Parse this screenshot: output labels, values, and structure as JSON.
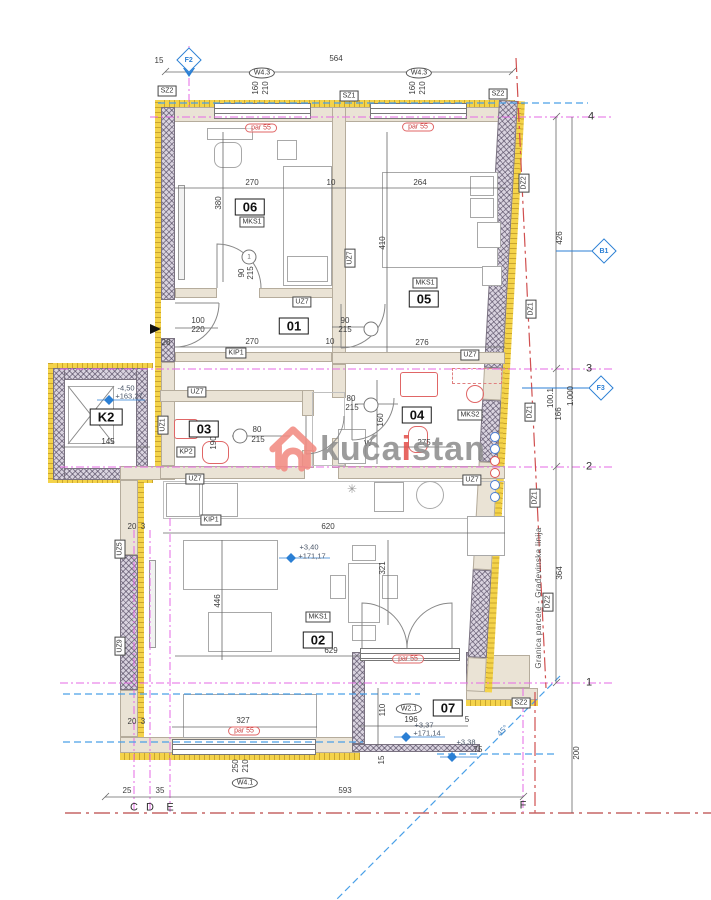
{
  "watermark": {
    "part1": "kuća",
    "part2": "i",
    "part3": "stan"
  },
  "colors": {
    "insulation_yellow": "#f4d34a",
    "wall_beige": "#eae3d5",
    "grid_magenta": "#e66ae6",
    "envelope_blue": "#4aa0e8",
    "boundary_red": "#d05050",
    "fixture_red": "#e06666",
    "marker_blue": "#2b7fd4",
    "watermark_gray": "#8f8f8f",
    "watermark_accent": "#e4534d"
  },
  "annotations": {
    "dimensions": [
      {
        "t": "15",
        "x": 159,
        "y": 61
      },
      {
        "t": "564",
        "x": 336,
        "y": 59
      },
      {
        "t": "270",
        "x": 252,
        "y": 183
      },
      {
        "t": "10",
        "x": 331,
        "y": 183
      },
      {
        "t": "264",
        "x": 420,
        "y": 183
      },
      {
        "t": "270",
        "x": 252,
        "y": 342
      },
      {
        "t": "10",
        "x": 330,
        "y": 342
      },
      {
        "t": "276",
        "x": 422,
        "y": 343
      },
      {
        "t": "100",
        "x": 198,
        "y": 321
      },
      {
        "t": "220",
        "x": 198,
        "y": 330
      },
      {
        "t": "28",
        "x": 166,
        "y": 343
      },
      {
        "t": "90",
        "x": 345,
        "y": 321
      },
      {
        "t": "215",
        "x": 345,
        "y": 330
      },
      {
        "t": "80",
        "x": 257,
        "y": 430
      },
      {
        "t": "215",
        "x": 258,
        "y": 440
      },
      {
        "t": "80",
        "x": 351,
        "y": 399
      },
      {
        "t": "215",
        "x": 352,
        "y": 408
      },
      {
        "t": "275",
        "x": 424,
        "y": 443
      },
      {
        "t": "145",
        "x": 108,
        "y": 442
      },
      {
        "t": "620",
        "x": 328,
        "y": 527
      },
      {
        "t": "629",
        "x": 331,
        "y": 651
      },
      {
        "t": "20",
        "x": 132,
        "y": 527
      },
      {
        "t": "3",
        "x": 143,
        "y": 527
      },
      {
        "t": "20",
        "x": 132,
        "y": 722
      },
      {
        "t": "3",
        "x": 143,
        "y": 722
      },
      {
        "t": "327",
        "x": 243,
        "y": 721
      },
      {
        "t": "196",
        "x": 411,
        "y": 720
      },
      {
        "t": "5",
        "x": 467,
        "y": 720
      },
      {
        "t": "75",
        "x": 478,
        "y": 750
      },
      {
        "t": "25",
        "x": 127,
        "y": 791
      },
      {
        "t": "35",
        "x": 160,
        "y": 791
      },
      {
        "t": "593",
        "x": 345,
        "y": 791
      },
      {
        "t": "W",
        "x": 368,
        "y": 444
      }
    ],
    "vertical_dimensions": [
      {
        "t": "160",
        "x": 256,
        "y": 88
      },
      {
        "t": "210",
        "x": 266,
        "y": 88
      },
      {
        "t": "160",
        "x": 413,
        "y": 88
      },
      {
        "t": "210",
        "x": 423,
        "y": 88
      },
      {
        "t": "380",
        "x": 219,
        "y": 203
      },
      {
        "t": "410",
        "x": 383,
        "y": 243
      },
      {
        "t": "90",
        "x": 242,
        "y": 273
      },
      {
        "t": "215",
        "x": 251,
        "y": 273
      },
      {
        "t": "160",
        "x": 381,
        "y": 420
      },
      {
        "t": "190",
        "x": 214,
        "y": 443
      },
      {
        "t": "446",
        "x": 218,
        "y": 601
      },
      {
        "t": "321",
        "x": 383,
        "y": 568
      },
      {
        "t": "426",
        "x": 560,
        "y": 238
      },
      {
        "t": "166",
        "x": 559,
        "y": 414
      },
      {
        "t": "364",
        "x": 560,
        "y": 573
      },
      {
        "t": "200",
        "x": 577,
        "y": 753
      },
      {
        "t": "110",
        "x": 383,
        "y": 710
      },
      {
        "t": "100.1",
        "x": 551,
        "y": 398
      },
      {
        "t": "1.000",
        "x": 571,
        "y": 396
      },
      {
        "t": "250",
        "x": 236,
        "y": 766
      },
      {
        "t": "210",
        "x": 246,
        "y": 766
      },
      {
        "t": "15",
        "x": 382,
        "y": 760
      }
    ],
    "wall_tags": [
      {
        "t": "SZ2",
        "x": 167,
        "y": 91
      },
      {
        "t": "SZ1",
        "x": 349,
        "y": 96
      },
      {
        "t": "SZ2",
        "x": 498,
        "y": 94
      },
      {
        "t": "UZ7",
        "x": 302,
        "y": 302
      },
      {
        "t": "UZ7",
        "x": 470,
        "y": 355
      },
      {
        "t": "UZ7",
        "x": 197,
        "y": 392
      },
      {
        "t": "UZ7",
        "x": 195,
        "y": 479
      },
      {
        "t": "UZ7",
        "x": 472,
        "y": 480
      },
      {
        "t": "KIP1",
        "x": 236,
        "y": 353
      },
      {
        "t": "KIP1",
        "x": 211,
        "y": 520
      },
      {
        "t": "KP2",
        "x": 186,
        "y": 452
      },
      {
        "t": "MKS1",
        "x": 252,
        "y": 222
      },
      {
        "t": "MKS1",
        "x": 425,
        "y": 283
      },
      {
        "t": "MKS1",
        "x": 318,
        "y": 617
      },
      {
        "t": "MKS2",
        "x": 470,
        "y": 415
      },
      {
        "t": "SZ2",
        "x": 521,
        "y": 703
      }
    ],
    "wall_tags_vertical": [
      {
        "t": "UZ7",
        "x": 350,
        "y": 258
      },
      {
        "t": "DZ2",
        "x": 524,
        "y": 183
      },
      {
        "t": "DZ1",
        "x": 531,
        "y": 309
      },
      {
        "t": "DZ1",
        "x": 530,
        "y": 412
      },
      {
        "t": "DZ1",
        "x": 535,
        "y": 498
      },
      {
        "t": "DZ2",
        "x": 548,
        "y": 602
      },
      {
        "t": "UZ1",
        "x": 163,
        "y": 425
      },
      {
        "t": "UZ5",
        "x": 120,
        "y": 549
      },
      {
        "t": "UZ9",
        "x": 120,
        "y": 646
      }
    ],
    "window_labels": [
      {
        "t": "W4.3",
        "x": 262,
        "y": 73
      },
      {
        "t": "W4.3",
        "x": 419,
        "y": 73
      },
      {
        "t": "W4.1",
        "x": 245,
        "y": 783
      },
      {
        "t": "W2.1",
        "x": 409,
        "y": 709
      }
    ],
    "room_numbers": [
      {
        "t": "06",
        "x": 250,
        "y": 207
      },
      {
        "t": "05",
        "x": 424,
        "y": 299
      },
      {
        "t": "01",
        "x": 294,
        "y": 326
      },
      {
        "t": "03",
        "x": 204,
        "y": 429
      },
      {
        "t": "04",
        "x": 417,
        "y": 415
      },
      {
        "t": "02",
        "x": 318,
        "y": 640
      },
      {
        "t": "07",
        "x": 448,
        "y": 708
      },
      {
        "t": "K2",
        "x": 106,
        "y": 417
      }
    ],
    "window_specs": [
      {
        "t": "par 55",
        "x": 261,
        "y": 128
      },
      {
        "t": "par 55",
        "x": 418,
        "y": 127
      },
      {
        "t": "par 55",
        "x": 244,
        "y": 731
      },
      {
        "t": "par 55",
        "x": 408,
        "y": 659
      }
    ],
    "elevations": [
      {
        "t": "-4,50",
        "x": 126,
        "y": 388
      },
      {
        "t": "+163,27",
        "x": 129,
        "y": 396
      },
      {
        "t": "+3,40",
        "x": 309,
        "y": 547
      },
      {
        "t": "+171,17",
        "x": 312,
        "y": 556
      },
      {
        "t": "+3,37",
        "x": 424,
        "y": 725
      },
      {
        "t": "+171,14",
        "x": 427,
        "y": 733
      },
      {
        "t": "+3,38",
        "x": 466,
        "y": 742
      }
    ],
    "grid_labels": [
      {
        "t": "4",
        "x": 591,
        "y": 117
      },
      {
        "t": "3",
        "x": 589,
        "y": 369
      },
      {
        "t": "2",
        "x": 589,
        "y": 467
      },
      {
        "t": "1",
        "x": 589,
        "y": 683
      },
      {
        "t": "C",
        "x": 134,
        "y": 808
      },
      {
        "t": "D",
        "x": 150,
        "y": 808
      },
      {
        "t": "E",
        "x": 170,
        "y": 808
      },
      {
        "t": "F",
        "x": 523,
        "y": 806
      }
    ],
    "grid_markers": [
      {
        "t": "F2",
        "x": 189,
        "y": 60
      },
      {
        "t": "B1",
        "x": 604,
        "y": 251
      },
      {
        "t": "F3",
        "x": 601,
        "y": 388
      }
    ],
    "door_numbers": [
      {
        "t": "1",
        "x": 249,
        "y": 257
      },
      {
        "t": "",
        "x": 371,
        "y": 329
      },
      {
        "t": "",
        "x": 240,
        "y": 436
      },
      {
        "t": "",
        "x": 371,
        "y": 405
      }
    ],
    "misc": [
      {
        "t": "Granica parcele - Građevinska linija",
        "x": 539,
        "y": 598,
        "c": "gtxt"
      },
      {
        "t": "45°",
        "x": 503,
        "y": 731,
        "c": "deg45"
      },
      {
        "t": "✳",
        "x": 352,
        "y": 489,
        "c": "star"
      }
    ]
  }
}
